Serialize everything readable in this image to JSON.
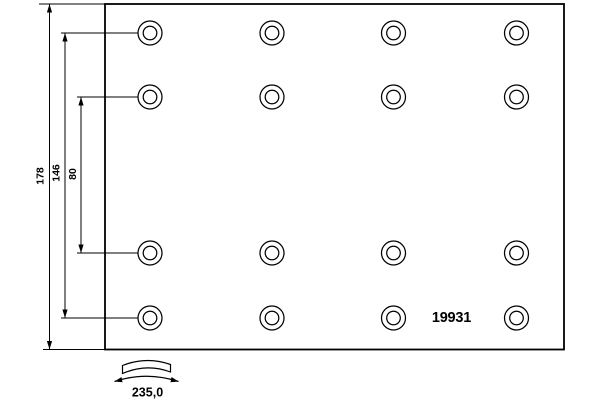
{
  "drawing": {
    "type": "brake-lining-technical-drawing",
    "part_number": "19931",
    "background_color": "#ffffff",
    "line_color": "#000000",
    "dimensions": {
      "overall_height": "178",
      "outer_hole_rows_span": "146",
      "inner_hole_rows_span": "80",
      "arc_width": "235,0"
    },
    "holes": {
      "grid": "4x4",
      "count": 16,
      "col_x": [
        150,
        272,
        393.5,
        516.5
      ],
      "row_y": [
        33,
        97,
        253,
        318
      ],
      "outer_r": 12,
      "inner_r": 6.8
    },
    "plate": {
      "x": 105,
      "y": 4,
      "width": 459,
      "height": 345.5
    }
  }
}
